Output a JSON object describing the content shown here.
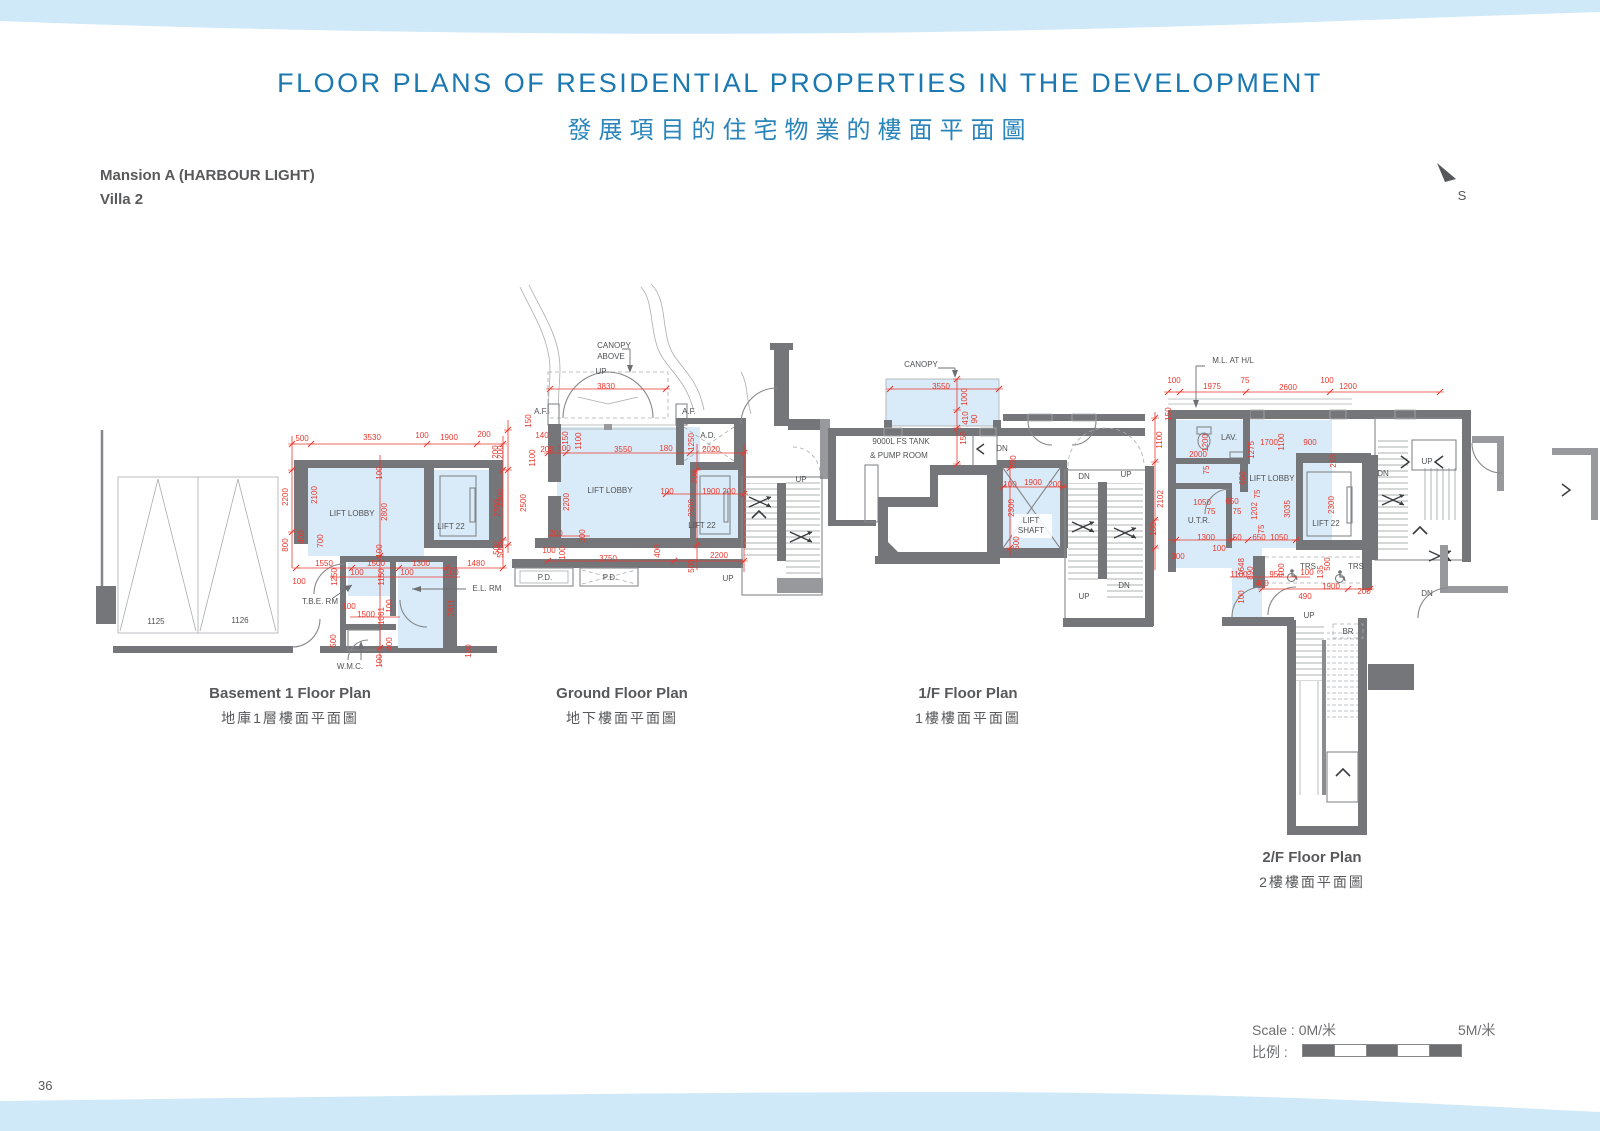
{
  "header": {
    "title_en": "FLOOR PLANS OF RESIDENTIAL PROPERTIES IN THE DEVELOPMENT",
    "title_zh": "發展項目的住宅物業的樓面平面圖",
    "block_name": "Mansion A (HARBOUR LIGHT)",
    "villa_name": "Villa 2",
    "compass_label": "S"
  },
  "footer": {
    "page_number": "36",
    "scale_label_en": "Scale : 0M/米",
    "scale_label_max": "5M/米",
    "scale_label_zh": "比例 :"
  },
  "colors": {
    "accent_blue": "#1b78b0",
    "band_blue": "#cfe9f8",
    "plan_fill_blue": "#d9ebf8",
    "wall_gray": "#74767a",
    "dimension_red": "#e8392e",
    "label_gray": "#505254"
  },
  "plans": [
    {
      "id": "b1",
      "caption_en": "Basement 1 Floor Plan",
      "caption_zh": "地庫1層樓面平面圖",
      "annotations": [
        [
          "500",
          302,
          441,
          "r"
        ],
        [
          "3530",
          372,
          440,
          "r"
        ],
        [
          "100",
          422,
          438,
          "r"
        ],
        [
          "1900",
          449,
          440,
          "r"
        ],
        [
          "200",
          484,
          437,
          "r"
        ],
        [
          "200",
          503,
          452,
          "r",
          -90
        ],
        [
          "2200",
          288,
          497,
          "r",
          -90
        ],
        [
          "2100",
          317,
          495,
          "r",
          -90
        ],
        [
          "100",
          382,
          473,
          "r",
          -90
        ],
        [
          "2800",
          387,
          512,
          "r",
          -90
        ],
        [
          "2300",
          503,
          498,
          "r",
          -90
        ],
        [
          "800",
          288,
          545,
          "r",
          -90
        ],
        [
          "400",
          304,
          537,
          "r",
          -90
        ],
        [
          "700",
          323,
          541,
          "r",
          -90
        ],
        [
          "100",
          382,
          551,
          "r",
          -90
        ],
        [
          "500",
          503,
          551,
          "r",
          -90
        ],
        [
          "1550",
          324,
          566,
          "r"
        ],
        [
          "1500",
          376,
          566,
          "r"
        ],
        [
          "1300",
          421,
          566,
          "r"
        ],
        [
          "1480",
          476,
          566,
          "r"
        ],
        [
          "100",
          299,
          584,
          "r"
        ],
        [
          "1250",
          337,
          577,
          "r",
          -90
        ],
        [
          "100",
          357,
          575,
          "r"
        ],
        [
          "1150",
          384,
          577,
          "r",
          -90
        ],
        [
          "100",
          407,
          575,
          "r"
        ],
        [
          "100",
          452,
          575,
          "r"
        ],
        [
          "2811",
          454,
          608,
          "r",
          -90
        ],
        [
          "100",
          349,
          609,
          "r"
        ],
        [
          "1500",
          366,
          617,
          "r"
        ],
        [
          "1061",
          384,
          616,
          "r",
          -90
        ],
        [
          "100",
          392,
          606,
          "r",
          -90
        ],
        [
          "500",
          336,
          641,
          "r",
          -90
        ],
        [
          "400",
          392,
          644,
          "r",
          -90
        ],
        [
          "100",
          382,
          661,
          "r",
          -90
        ],
        [
          "100",
          471,
          651,
          "r",
          -90
        ],
        [
          "LIFT LOBBY",
          352,
          516,
          "g"
        ],
        [
          "LIFT 22",
          451,
          529,
          "g"
        ],
        [
          "1125",
          156,
          624,
          "g"
        ],
        [
          "1126",
          240,
          623,
          "g"
        ],
        [
          "T.B.E. RM",
          320,
          604,
          "g"
        ],
        [
          "E.L. RM",
          487,
          591,
          "g"
        ],
        [
          "W.M.C.",
          350,
          669,
          "g"
        ]
      ]
    },
    {
      "id": "gf",
      "caption_en": "Ground Floor Plan",
      "caption_zh": "地下樓面平面圖",
      "annotations": [
        [
          "CANOPY",
          614,
          348,
          "g"
        ],
        [
          "ABOVE",
          611,
          359,
          "g"
        ],
        [
          "UP",
          601,
          374,
          "g"
        ],
        [
          "A.F.",
          541,
          414,
          "g"
        ],
        [
          "A.F.",
          689,
          414,
          "g"
        ],
        [
          "A.D.",
          708,
          438,
          "g"
        ],
        [
          "LIFT LOBBY",
          610,
          493,
          "g"
        ],
        [
          "LIFT 22",
          702,
          528,
          "g"
        ],
        [
          "P.D.",
          545,
          580,
          "g"
        ],
        [
          "P.D.",
          610,
          580,
          "g"
        ],
        [
          "UP",
          801,
          482,
          "g"
        ],
        [
          "UP",
          728,
          581,
          "g"
        ],
        [
          "3830",
          606,
          389,
          "r"
        ],
        [
          "150",
          531,
          421,
          "r",
          -90
        ],
        [
          "140",
          542,
          438,
          "r"
        ],
        [
          "150",
          568,
          438,
          "r",
          -90
        ],
        [
          "1100",
          581,
          441,
          "r",
          -90
        ],
        [
          "200",
          547,
          452,
          "r"
        ],
        [
          "100",
          564,
          451,
          "r"
        ],
        [
          "1100",
          535,
          458,
          "r",
          -90
        ],
        [
          "3550",
          623,
          452,
          "r"
        ],
        [
          "180",
          666,
          451,
          "r"
        ],
        [
          "1250",
          694,
          442,
          "r",
          -90
        ],
        [
          "2020",
          711,
          452,
          "r"
        ],
        [
          "200",
          498,
          452,
          "r",
          -90
        ],
        [
          "2300",
          500,
          508,
          "r",
          -90
        ],
        [
          "500",
          499,
          548,
          "r",
          -90
        ],
        [
          "2500",
          526,
          503,
          "r",
          -90
        ],
        [
          "2200",
          569,
          502,
          "r",
          -90
        ],
        [
          "100",
          667,
          494,
          "r"
        ],
        [
          "1900",
          711,
          494,
          "r"
        ],
        [
          "200",
          729,
          494,
          "r"
        ],
        [
          "200",
          697,
          477,
          "r",
          -90
        ],
        [
          "2300",
          694,
          508,
          "r",
          -90
        ],
        [
          "200",
          556,
          536,
          "r"
        ],
        [
          "300",
          585,
          536,
          "r",
          -90
        ],
        [
          "100",
          549,
          553,
          "r"
        ],
        [
          "100",
          565,
          553,
          "r",
          -90
        ],
        [
          "3750",
          608,
          561,
          "r"
        ],
        [
          "400",
          660,
          551,
          "r",
          -90
        ],
        [
          "500",
          694,
          566,
          "r",
          -90
        ],
        [
          "2200",
          719,
          558,
          "r"
        ]
      ]
    },
    {
      "id": "f1",
      "caption_en": "1/F Floor Plan",
      "caption_zh": "1樓樓面平面圖",
      "annotations": [
        [
          "CANOPY",
          921,
          367,
          "g"
        ],
        [
          "9000L FS TANK",
          901,
          444,
          "g"
        ],
        [
          "& PUMP ROOM",
          899,
          458,
          "g"
        ],
        [
          "DN",
          1002,
          451,
          "g"
        ],
        [
          "LIFT",
          1031,
          523,
          "g"
        ],
        [
          "SHAFT",
          1031,
          533,
          "g"
        ],
        [
          "DN",
          1084,
          479,
          "g"
        ],
        [
          "UP",
          1126,
          477,
          "g"
        ],
        [
          "UP",
          1084,
          599,
          "g"
        ],
        [
          "DN",
          1124,
          588,
          "g"
        ],
        [
          "3550",
          941,
          389,
          "r"
        ],
        [
          "1000",
          967,
          397,
          "r",
          -90
        ],
        [
          "410",
          968,
          418,
          "r",
          -90
        ],
        [
          "90",
          977,
          419,
          "r",
          -90
        ],
        [
          "150",
          966,
          438,
          "r",
          -90
        ],
        [
          "200",
          1016,
          462,
          "r",
          -90
        ],
        [
          "100",
          1010,
          487,
          "r"
        ],
        [
          "1900",
          1033,
          485,
          "r"
        ],
        [
          "200",
          1055,
          487,
          "r"
        ],
        [
          "2300",
          1014,
          508,
          "r",
          -90
        ],
        [
          "500",
          1019,
          543,
          "r",
          -90
        ]
      ]
    },
    {
      "id": "f2",
      "caption_en": "2/F Floor Plan",
      "caption_zh": "2樓樓面平面圖",
      "annotations": [
        [
          "M.L. AT H/L",
          1233,
          363,
          "g"
        ],
        [
          "LAV.",
          1229,
          440,
          "g"
        ],
        [
          "LIFT LOBBY",
          1272,
          481,
          "g"
        ],
        [
          "U.T.R.",
          1199,
          523,
          "g"
        ],
        [
          "LIFT 22",
          1326,
          526,
          "g"
        ],
        [
          "TRS",
          1308,
          569,
          "g"
        ],
        [
          "TRS",
          1356,
          569,
          "g"
        ],
        [
          "UP",
          1309,
          618,
          "g"
        ],
        [
          "DN",
          1383,
          476,
          "g"
        ],
        [
          "UP",
          1427,
          464,
          "g"
        ],
        [
          "DN",
          1427,
          596,
          "g"
        ],
        [
          "BR",
          1348,
          634,
          "g"
        ],
        [
          "100",
          1174,
          383,
          "r"
        ],
        [
          "1975",
          1212,
          389,
          "r"
        ],
        [
          "75",
          1245,
          383,
          "r"
        ],
        [
          "2600",
          1288,
          390,
          "r"
        ],
        [
          "100",
          1327,
          383,
          "r"
        ],
        [
          "1200",
          1348,
          389,
          "r"
        ],
        [
          "150",
          1171,
          414,
          "r",
          -90
        ],
        [
          "1100",
          1162,
          440,
          "r",
          -90
        ],
        [
          "1200",
          1208,
          443,
          "r",
          -90
        ],
        [
          "2000",
          1198,
          457,
          "r"
        ],
        [
          "1700",
          1269,
          445,
          "r"
        ],
        [
          "1100",
          1284,
          442,
          "r",
          -90
        ],
        [
          "900",
          1310,
          445,
          "r"
        ],
        [
          "1275",
          1254,
          450,
          "r",
          -90
        ],
        [
          "210",
          1336,
          461,
          "r",
          -90
        ],
        [
          "75",
          1209,
          470,
          "r",
          -90
        ],
        [
          "650",
          1245,
          478,
          "r",
          -90
        ],
        [
          "2102",
          1163,
          499,
          "r",
          -90
        ],
        [
          "1050",
          1202,
          505,
          "r"
        ],
        [
          "650",
          1232,
          504,
          "r"
        ],
        [
          "75",
          1211,
          514,
          "r"
        ],
        [
          "75",
          1237,
          514,
          "r"
        ],
        [
          "1202",
          1257,
          511,
          "r",
          -90
        ],
        [
          "75",
          1260,
          494,
          "r",
          -90
        ],
        [
          "3035",
          1290,
          509,
          "r",
          -90
        ],
        [
          "2300",
          1334,
          505,
          "r",
          -90
        ],
        [
          "100",
          1156,
          529,
          "r",
          -90
        ],
        [
          "1300",
          1206,
          540,
          "r"
        ],
        [
          "450",
          1235,
          540,
          "r"
        ],
        [
          "650",
          1259,
          540,
          "r"
        ],
        [
          "1050",
          1279,
          540,
          "r"
        ],
        [
          "100",
          1219,
          551,
          "r"
        ],
        [
          "300",
          1178,
          559,
          "r"
        ],
        [
          "75",
          1264,
          529,
          "r",
          -90
        ],
        [
          "1648",
          1244,
          567,
          "r",
          -90
        ],
        [
          "1100",
          1239,
          577,
          "r"
        ],
        [
          "890",
          1253,
          573,
          "r",
          -90
        ],
        [
          "100",
          1284,
          570,
          "r",
          -90
        ],
        [
          "950",
          1276,
          577,
          "r"
        ],
        [
          "100",
          1307,
          575,
          "r"
        ],
        [
          "135",
          1323,
          572,
          "r",
          -90
        ],
        [
          "500",
          1330,
          564,
          "r",
          -90
        ],
        [
          "100",
          1244,
          597,
          "r",
          -90
        ],
        [
          "400",
          1262,
          586,
          "r"
        ],
        [
          "1900",
          1331,
          589,
          "r"
        ],
        [
          "490",
          1305,
          599,
          "r"
        ],
        [
          "200",
          1364,
          594,
          "r"
        ]
      ]
    }
  ]
}
